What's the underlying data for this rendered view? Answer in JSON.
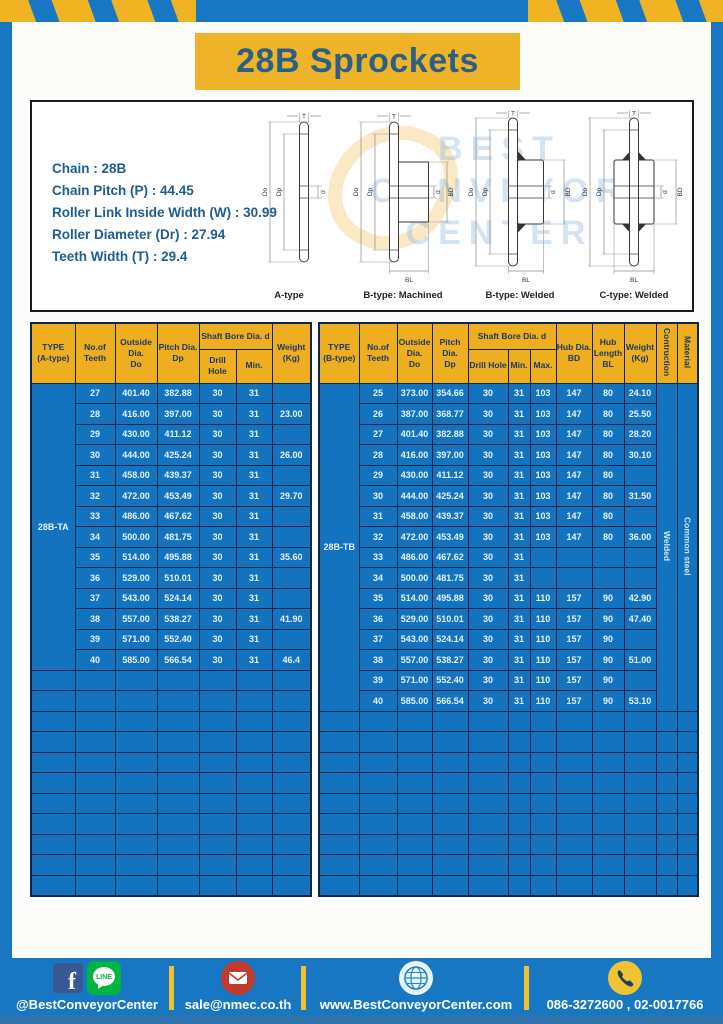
{
  "title": "28B Sprockets",
  "colors": {
    "brand_blue": "#1877c2",
    "accent_yellow": "#efb32a",
    "table_cell_blue": "#1373bf",
    "border_navy": "#0d2747",
    "title_navy": "#2c5f85"
  },
  "specs": {
    "lines": [
      "Chain  : 28B",
      "Chain Pitch (P)  : 44.45",
      "Roller Link Inside Width (W)  : 30.99",
      "Roller Diameter (Dr)  : 27.94",
      "Teeth Width (T)  : 29.4"
    ]
  },
  "watermark": {
    "line1": "BEST",
    "line2": "CONVEYOR",
    "line3": "CENTER"
  },
  "diagrams": {
    "captions": [
      "A-type",
      "B-type: Machined",
      "B-type: Welded",
      "C-type: Welded"
    ],
    "dims": {
      "T": "T",
      "Do": "Do",
      "Dp": "Dp",
      "d": "d",
      "BD": "BD",
      "BL": "BL"
    }
  },
  "table_a": {
    "headers": {
      "type": "TYPE\n(A-type)",
      "teeth": "No.of\nTeeth",
      "outside": "Outside\nDia.\nDo",
      "pitch": "Pitch Dia.\nDp",
      "shaft_bore": "Shaft Bore Dia. d",
      "drill": "Drill Hole",
      "min": "Min.",
      "weight": "Weight\n(Kg)"
    },
    "type_label": "28B-TA",
    "rows": [
      [
        "27",
        "401.40",
        "382.88",
        "30",
        "31",
        ""
      ],
      [
        "28",
        "416.00",
        "397.00",
        "30",
        "31",
        "23.00"
      ],
      [
        "29",
        "430.00",
        "411.12",
        "30",
        "31",
        ""
      ],
      [
        "30",
        "444.00",
        "425.24",
        "30",
        "31",
        "26.00"
      ],
      [
        "31",
        "458.00",
        "439.37",
        "30",
        "31",
        ""
      ],
      [
        "32",
        "472.00",
        "453.49",
        "30",
        "31",
        "29.70"
      ],
      [
        "33",
        "486.00",
        "467.62",
        "30",
        "31",
        ""
      ],
      [
        "34",
        "500.00",
        "481.75",
        "30",
        "31",
        ""
      ],
      [
        "35",
        "514.00",
        "495.88",
        "30",
        "31",
        "35.60"
      ],
      [
        "36",
        "529.00",
        "510.01",
        "30",
        "31",
        ""
      ],
      [
        "37",
        "543.00",
        "524.14",
        "30",
        "31",
        ""
      ],
      [
        "38",
        "557.00",
        "538.27",
        "30",
        "31",
        "41.90"
      ],
      [
        "39",
        "571.00",
        "552.40",
        "30",
        "31",
        ""
      ],
      [
        "40",
        "585.00",
        "566.54",
        "30",
        "31",
        "46.4"
      ]
    ],
    "empty_rows": 11
  },
  "table_b": {
    "headers": {
      "type": "TYPE\n(B-type)",
      "teeth": "No.of\nTeeth",
      "outside": "Outside\nDia.\nDo",
      "pitch": "Pitch Dia.\nDp",
      "shaft_bore": "Shaft Bore Dia. d",
      "drill": "Drill Hole",
      "min": "Min.",
      "max": "Max.",
      "hub_dia": "Hub Dia.\nBD",
      "hub_len": "Hub\nLength\nBL",
      "weight": "Weight\n(Kg)",
      "construction": "Contruction",
      "material": "Material"
    },
    "type_label": "28B-TB",
    "construction": "Welded",
    "material": "Common steel",
    "rows": [
      [
        "25",
        "373.00",
        "354.66",
        "30",
        "31",
        "103",
        "147",
        "80",
        "24.10"
      ],
      [
        "26",
        "387.00",
        "368.77",
        "30",
        "31",
        "103",
        "147",
        "80",
        "25.50"
      ],
      [
        "27",
        "401.40",
        "382.88",
        "30",
        "31",
        "103",
        "147",
        "80",
        "28.20"
      ],
      [
        "28",
        "416.00",
        "397.00",
        "30",
        "31",
        "103",
        "147",
        "80",
        "30.10"
      ],
      [
        "29",
        "430.00",
        "411.12",
        "30",
        "31",
        "103",
        "147",
        "80",
        ""
      ],
      [
        "30",
        "444.00",
        "425.24",
        "30",
        "31",
        "103",
        "147",
        "80",
        "31.50"
      ],
      [
        "31",
        "458.00",
        "439.37",
        "30",
        "31",
        "103",
        "147",
        "80",
        ""
      ],
      [
        "32",
        "472.00",
        "453.49",
        "30",
        "31",
        "103",
        "147",
        "80",
        "36.00"
      ],
      [
        "33",
        "486.00",
        "467.62",
        "30",
        "31",
        "",
        "",
        "",
        ""
      ],
      [
        "34",
        "500.00",
        "481.75",
        "30",
        "31",
        "",
        "",
        "",
        ""
      ],
      [
        "35",
        "514.00",
        "495.88",
        "30",
        "31",
        "110",
        "157",
        "90",
        "42.90"
      ],
      [
        "36",
        "529.00",
        "510.01",
        "30",
        "31",
        "110",
        "157",
        "90",
        "47.40"
      ],
      [
        "37",
        "543.00",
        "524.14",
        "30",
        "31",
        "110",
        "157",
        "90",
        ""
      ],
      [
        "38",
        "557.00",
        "538.27",
        "30",
        "31",
        "110",
        "157",
        "90",
        "51.00"
      ],
      [
        "39",
        "571.00",
        "552.40",
        "30",
        "31",
        "110",
        "157",
        "90",
        ""
      ],
      [
        "40",
        "585.00",
        "566.54",
        "30",
        "31",
        "110",
        "157",
        "90",
        "53.10"
      ]
    ],
    "empty_rows": 9
  },
  "footer": {
    "social": "@BestConveyorCenter",
    "email": "sale@nmec.co.th",
    "website": "www.BestConveyorCenter.com",
    "phones": "086-3272600 , 02-0017766"
  }
}
